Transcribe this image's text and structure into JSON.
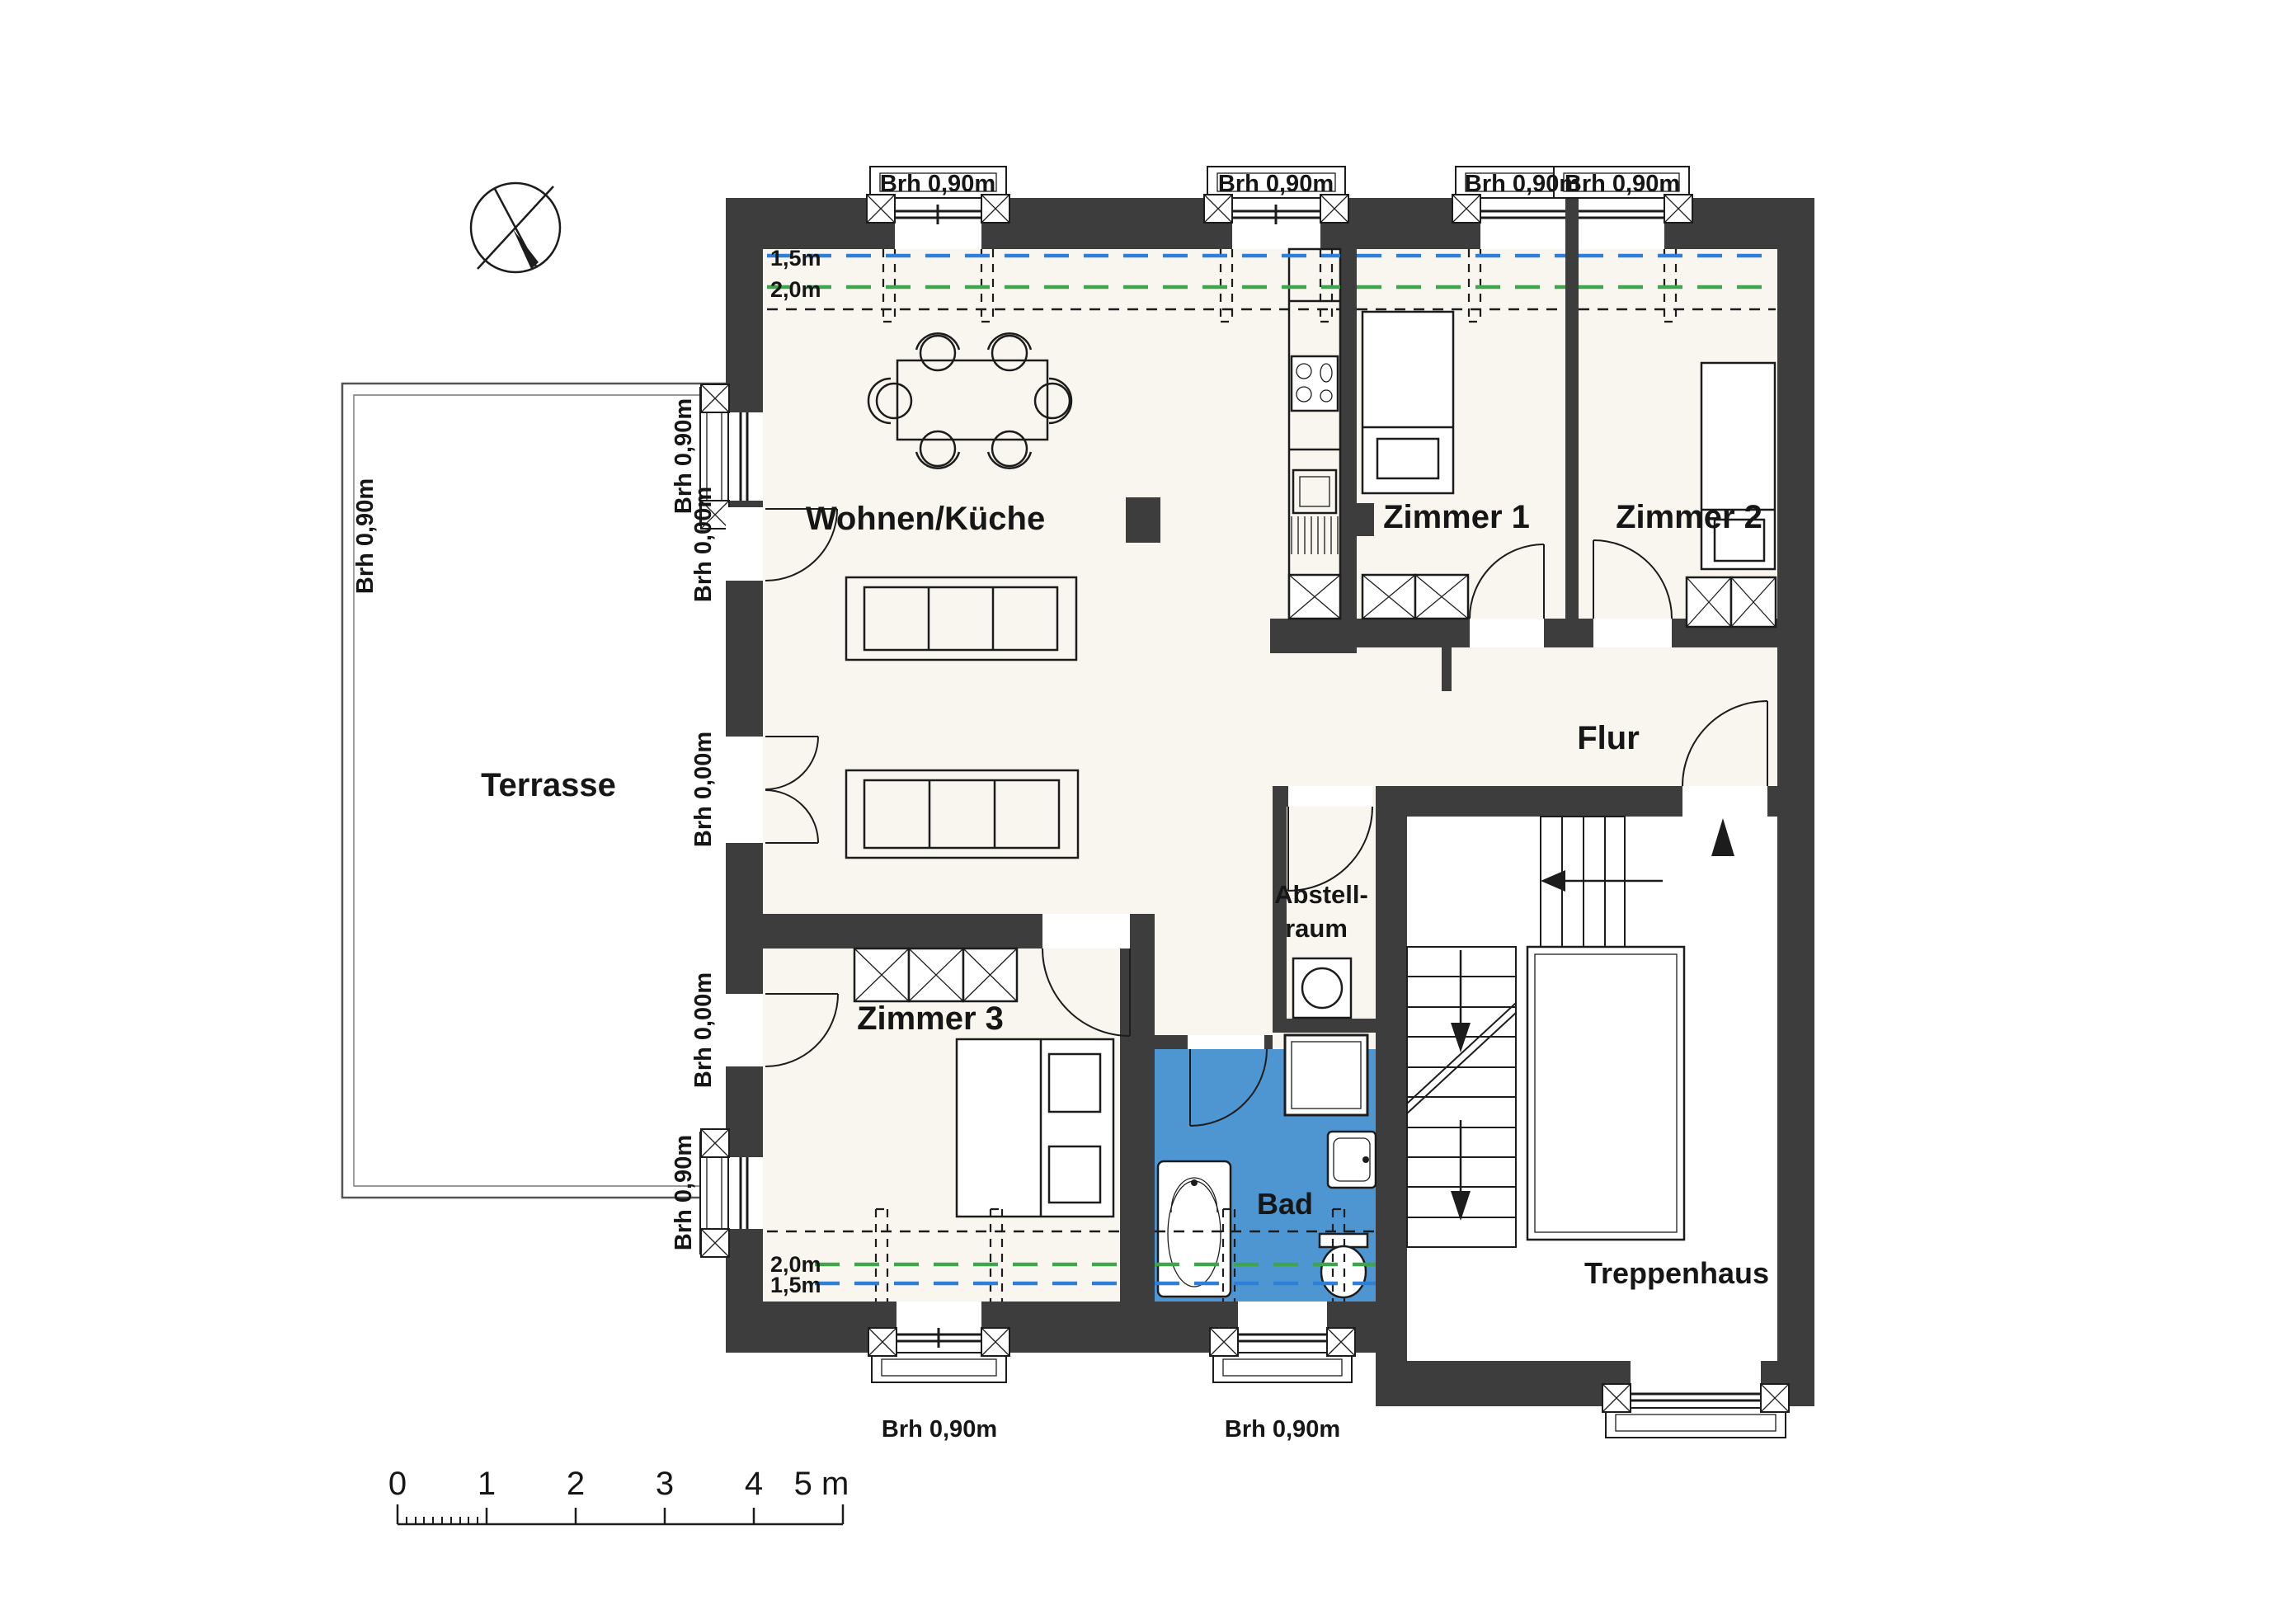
{
  "plan": {
    "rooms": {
      "living": "Wohnen/Küche",
      "room1": "Zimmer 1",
      "room2": "Zimmer 2",
      "room3": "Zimmer 3",
      "hallway": "Flur",
      "storage1": "Abstell-",
      "storage2": "raum",
      "bath": "Bad",
      "stairwell": "Treppenhaus",
      "terrace": "Terrasse"
    },
    "sills": {
      "h090": "Brh 0,90m",
      "h000": "Brh 0,00m"
    },
    "roof_heights": {
      "m15": "1,5m",
      "m20": "2,0m"
    },
    "scale_bar": {
      "t0": "0",
      "t1": "1",
      "t2": "2",
      "t3": "3",
      "t4": "4",
      "t5": "5 m"
    },
    "colors": {
      "wall": "#3d3d3d",
      "bath": "#4e96d2",
      "line15": "#2e7fd9",
      "line20": "#3fa54d",
      "floor": "#f8f6ef"
    }
  }
}
